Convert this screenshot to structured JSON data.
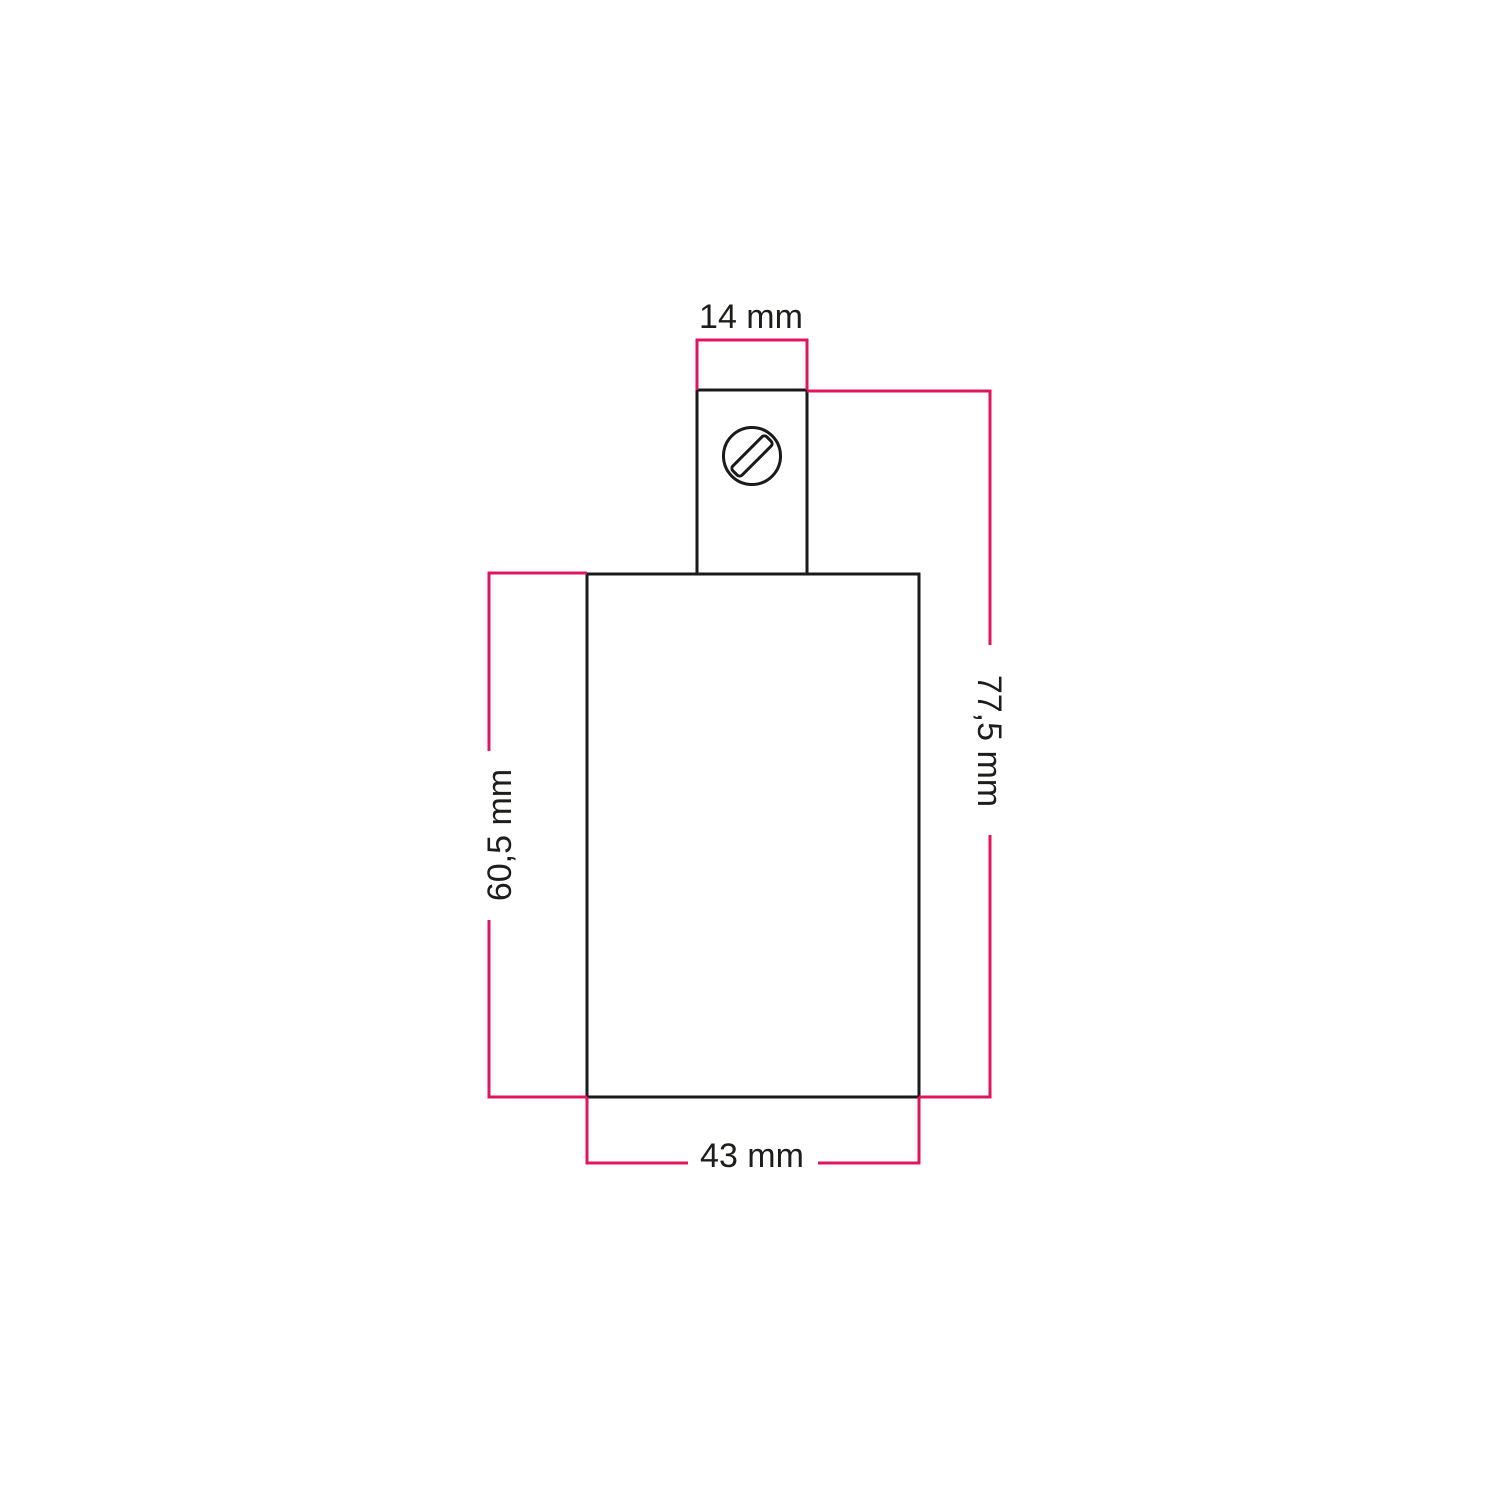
{
  "diagram": {
    "kind": "technical dimension drawing",
    "colors": {
      "background": "#ffffff",
      "outline": "#1a1a1a",
      "dimension_line": "#e0145f",
      "text": "#1d1d1b"
    },
    "dimensions": {
      "top_width": {
        "label": "14 mm",
        "position": "top",
        "orientation": "horizontal"
      },
      "total_height": {
        "label": "77,5 mm",
        "position": "right",
        "orientation": "vertical"
      },
      "body_height": {
        "label": "60,5 mm",
        "position": "left",
        "orientation": "vertical"
      },
      "body_width": {
        "label": "43 mm",
        "position": "bottom",
        "orientation": "horizontal"
      }
    },
    "icons": {
      "screw": "slotted-screw-head-icon"
    }
  }
}
